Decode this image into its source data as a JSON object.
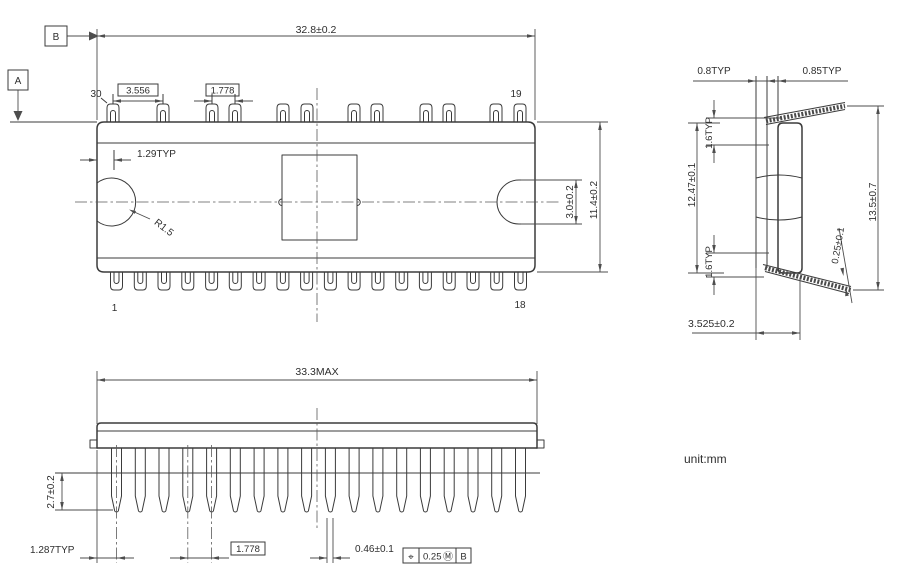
{
  "unit_note": "unit:mm",
  "datums": {
    "a": "A",
    "b": "B"
  },
  "top_view": {
    "pin_top_left": "30",
    "pin_top_right": "19",
    "pin_bottom_left": "1",
    "pin_bottom_right": "18",
    "dim_overall_width": "32.8±0.2",
    "dim_pin_group_pitch": "3.556",
    "dim_pin_pitch": "1.778",
    "dim_edge_offset": "1.29TYP",
    "dim_notch_radius": "R1.5",
    "dim_slot_width": "3.0±0.2",
    "dim_body_depth": "11.4±0.2"
  },
  "side_view": {
    "dim_lead_row_offset": "0.8TYP",
    "dim_lead_row_offset_2": "0.85TYP",
    "dim_shoulder_top": "1.6TYP",
    "dim_body_length": "12.47±0.1",
    "dim_shoulder_bottom": "1.6TYP",
    "dim_overall_height": "13.5±0.7",
    "dim_lead_thickness": "0.25±0.1",
    "dim_body_thickness": "3.525±0.2"
  },
  "front_view": {
    "dim_overall_width": "33.3MAX",
    "dim_lead_tip_length": "2.7±0.2",
    "dim_edge_to_first_pin": "1.287TYP",
    "dim_lead_pitch": "1.778",
    "dim_lead_width": "0.46±0.1",
    "tolerance_frame": {
      "symbol": "⌖",
      "value": "0.25",
      "modifier": "Ⓜ",
      "datum": "B"
    }
  }
}
